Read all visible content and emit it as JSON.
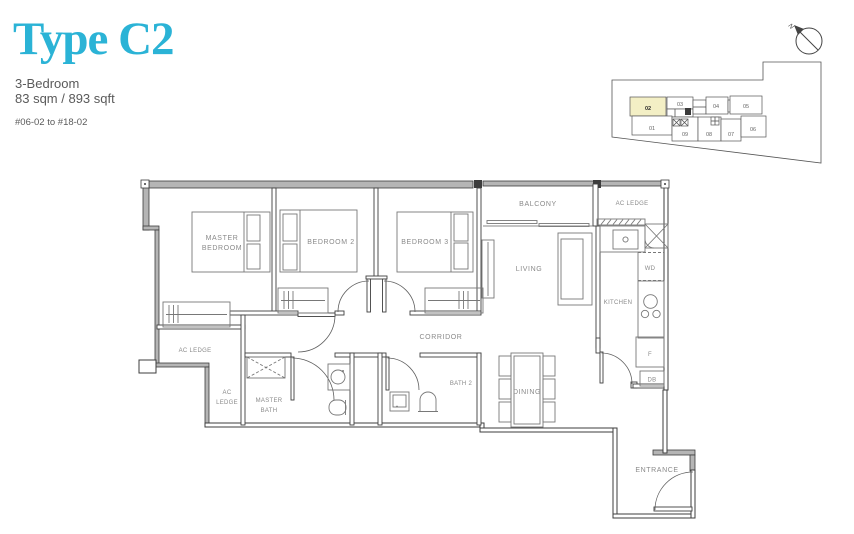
{
  "header": {
    "title": "Type C2",
    "subtitle_type": "3-Bedroom",
    "subtitle_area": "83 sqm / 893 sqft",
    "unit_range": "#06-02 to #18-02"
  },
  "colors": {
    "accent": "#2bb3d6",
    "wall_gray": "#b5b5b5",
    "line_dark": "#3d3d3d",
    "label_gray": "#8a8a8a",
    "unit_highlight": "#f3efc5"
  },
  "compass": {
    "north_label": "N"
  },
  "key_plan": {
    "highlighted_unit": "02",
    "units": [
      "01",
      "02",
      "03",
      "04",
      "05",
      "06",
      "07",
      "08",
      "09"
    ]
  },
  "floor_plan": {
    "labels": {
      "master_bedroom_line1": "MASTER",
      "master_bedroom_line2": "BEDROOM",
      "bedroom2": "BEDROOM 2",
      "bedroom3": "BEDROOM 3",
      "balcony": "BALCONY",
      "ac_ledge_top": "AC LEDGE",
      "living": "LIVING",
      "kitchen": "KITCHEN",
      "wd": "WD",
      "corridor": "CORRIDOR",
      "ac_ledge_left": "AC LEDGE",
      "ac_ledge_lower_line1": "AC",
      "ac_ledge_lower_line2": "LEDGE",
      "master_bath_line1": "MASTER",
      "master_bath_line2": "BATH",
      "bath2": "BATH 2",
      "dining": "DINING",
      "fridge": "F",
      "db": "DB",
      "entrance": "ENTRANCE"
    }
  }
}
